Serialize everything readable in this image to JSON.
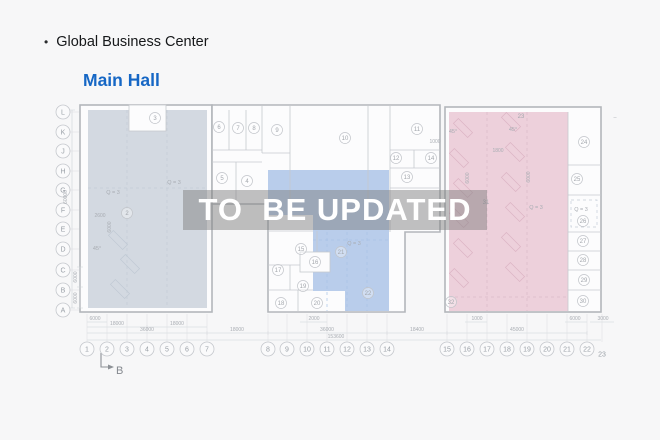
{
  "header": {
    "bullet": "•",
    "title": "Global Business Center",
    "subtitle": "Main Hall"
  },
  "watermark": {
    "text": "TO  BE UPDATED"
  },
  "colors": {
    "background": "#f7f7f8",
    "subtitle_blue": "#1667c5",
    "zone_gray": "#d3d9e1",
    "zone_blue": "#b9cdeb",
    "zone_pink": "#edd0db",
    "watermark_bg": "rgba(126,126,126,0.48)",
    "watermark_text": "#ffffff"
  },
  "plan": {
    "grid_rows": [
      {
        "label": "L",
        "y": 112
      },
      {
        "label": "K",
        "y": 132
      },
      {
        "label": "J",
        "y": 151
      },
      {
        "label": "H",
        "y": 171
      },
      {
        "label": "G",
        "y": 190
      },
      {
        "label": "F",
        "y": 210
      },
      {
        "label": "E",
        "y": 229
      },
      {
        "label": "D",
        "y": 249
      },
      {
        "label": "C",
        "y": 270
      },
      {
        "label": "B",
        "y": 290
      },
      {
        "label": "A",
        "y": 310
      }
    ],
    "grid_cols": [
      {
        "label": "1",
        "x": 87
      },
      {
        "label": "2",
        "x": 107
      },
      {
        "label": "3",
        "x": 127
      },
      {
        "label": "4",
        "x": 147
      },
      {
        "label": "5",
        "x": 167
      },
      {
        "label": "6",
        "x": 187
      },
      {
        "label": "7",
        "x": 207
      },
      {
        "label": "8",
        "x": 268
      },
      {
        "label": "9",
        "x": 287
      },
      {
        "label": "10",
        "x": 307
      },
      {
        "label": "11",
        "x": 327
      },
      {
        "label": "12",
        "x": 347
      },
      {
        "label": "13",
        "x": 367
      },
      {
        "label": "14",
        "x": 387
      },
      {
        "label": "15",
        "x": 447
      },
      {
        "label": "16",
        "x": 467
      },
      {
        "label": "17",
        "x": 487
      },
      {
        "label": "18",
        "x": 507
      },
      {
        "label": "19",
        "x": 527
      },
      {
        "label": "20",
        "x": 547
      },
      {
        "label": "21",
        "x": 567
      },
      {
        "label": "22",
        "x": 587
      },
      {
        "label": "23",
        "x": 602,
        "circle": false,
        "dy": 5
      }
    ],
    "rooms": [
      {
        "n": "2",
        "x": 127,
        "y": 213
      },
      {
        "n": "3",
        "x": 155,
        "y": 118
      },
      {
        "n": "4",
        "x": 247,
        "y": 181
      },
      {
        "n": "5",
        "x": 222,
        "y": 178
      },
      {
        "n": "6",
        "x": 219,
        "y": 127
      },
      {
        "n": "7",
        "x": 238,
        "y": 128
      },
      {
        "n": "8",
        "x": 254,
        "y": 128
      },
      {
        "n": "9",
        "x": 277,
        "y": 130
      },
      {
        "n": "10",
        "x": 345,
        "y": 138
      },
      {
        "n": "11",
        "x": 417,
        "y": 129
      },
      {
        "n": "12",
        "x": 396,
        "y": 158
      },
      {
        "n": "13",
        "x": 407,
        "y": 177
      },
      {
        "n": "14",
        "x": 431,
        "y": 158
      },
      {
        "n": "15",
        "x": 301,
        "y": 249
      },
      {
        "n": "16",
        "x": 315,
        "y": 262
      },
      {
        "n": "17",
        "x": 278,
        "y": 270
      },
      {
        "n": "18",
        "x": 281,
        "y": 303
      },
      {
        "n": "19",
        "x": 303,
        "y": 286
      },
      {
        "n": "20",
        "x": 317,
        "y": 303
      },
      {
        "n": "21",
        "x": 341,
        "y": 252
      },
      {
        "n": "22",
        "x": 368,
        "y": 293
      },
      {
        "n": "23",
        "x": 521,
        "y": 116,
        "circle": false
      },
      {
        "n": "24",
        "x": 584,
        "y": 142
      },
      {
        "n": "25",
        "x": 577,
        "y": 179
      },
      {
        "n": "26",
        "x": 583,
        "y": 221
      },
      {
        "n": "27",
        "x": 583,
        "y": 241
      },
      {
        "n": "28",
        "x": 583,
        "y": 260
      },
      {
        "n": "29",
        "x": 584,
        "y": 280
      },
      {
        "n": "30",
        "x": 583,
        "y": 301
      },
      {
        "n": "31",
        "x": 486,
        "y": 202,
        "circle": false
      },
      {
        "n": "32",
        "x": 451,
        "y": 302
      }
    ],
    "dims": [
      {
        "t": "6000",
        "x": 95,
        "y": 320
      },
      {
        "t": "18000",
        "x": 117,
        "y": 325
      },
      {
        "t": "18000",
        "x": 177,
        "y": 325
      },
      {
        "t": "36000",
        "x": 147,
        "y": 331
      },
      {
        "t": "18000",
        "x": 237,
        "y": 331
      },
      {
        "t": "2000",
        "x": 314,
        "y": 320
      },
      {
        "t": "36000",
        "x": 327,
        "y": 331
      },
      {
        "t": "153600",
        "x": 336,
        "y": 338
      },
      {
        "t": "18400",
        "x": 417,
        "y": 331
      },
      {
        "t": "1000",
        "x": 477,
        "y": 320
      },
      {
        "t": "45000",
        "x": 517,
        "y": 331
      },
      {
        "t": "6000",
        "x": 575,
        "y": 320
      },
      {
        "t": "3000",
        "x": 603,
        "y": 320
      },
      {
        "t": "60000",
        "x": 67,
        "y": 197,
        "rot": true
      },
      {
        "t": "6000",
        "x": 77,
        "y": 277,
        "rot": true
      },
      {
        "t": "6000",
        "x": 77,
        "y": 298,
        "rot": true
      },
      {
        "t": "2600",
        "x": 100,
        "y": 217
      },
      {
        "t": "6000",
        "x": 111,
        "y": 227,
        "rot": true
      },
      {
        "t": "1800",
        "x": 498,
        "y": 152
      },
      {
        "t": "1000",
        "x": 435,
        "y": 143
      },
      {
        "t": "6000",
        "x": 469,
        "y": 178,
        "rot": true
      },
      {
        "t": "6000",
        "x": 530,
        "y": 177,
        "rot": true
      }
    ],
    "annotations": [
      {
        "t": "Q = 3",
        "x": 113,
        "y": 194
      },
      {
        "t": "Q = 3",
        "x": 174,
        "y": 184
      },
      {
        "t": "Q = 3",
        "x": 354,
        "y": 245
      },
      {
        "t": "Q = 3",
        "x": 536,
        "y": 209
      },
      {
        "t": "Q = 3",
        "x": 581,
        "y": 211
      },
      {
        "t": "45°",
        "x": 97,
        "y": 250
      },
      {
        "t": "45°",
        "x": 453,
        "y": 133
      },
      {
        "t": "45°",
        "x": 513,
        "y": 131
      },
      {
        "t": "–",
        "x": 615,
        "y": 119
      }
    ],
    "section_marker": {
      "label": "B"
    }
  }
}
